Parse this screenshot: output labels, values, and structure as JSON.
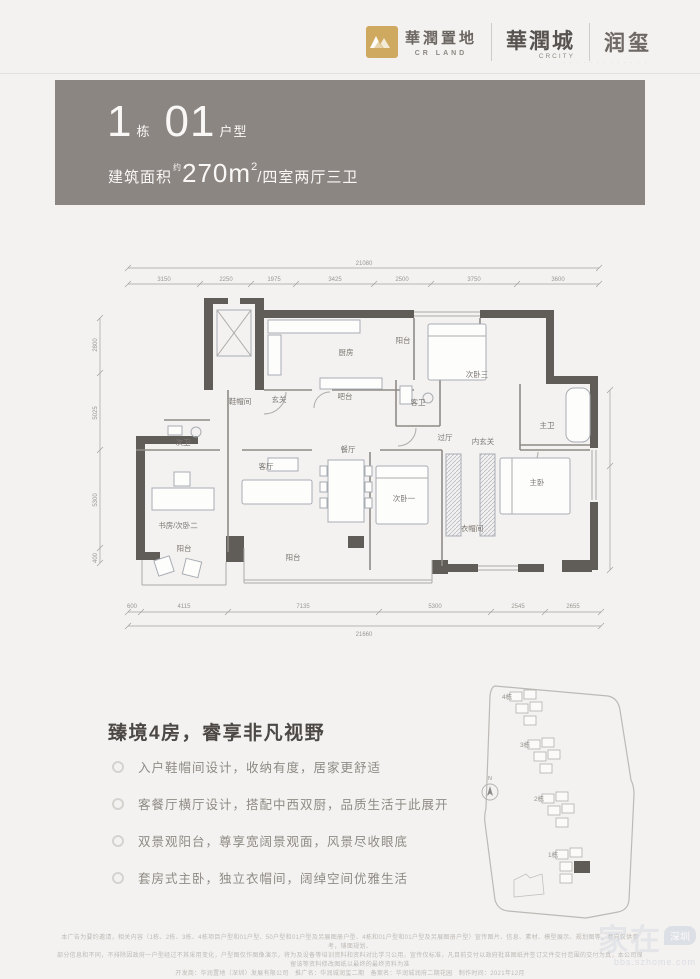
{
  "brand": {
    "crland_cn": "華潤置地",
    "crland_en": "CR LAND",
    "crcity_cn": "華潤城",
    "crcity_en": "CRCITY",
    "runxi": "润玺",
    "tagline": "∙ ∙ ∙   ∙ ∙ ∙ ∙ ∙ ∙ ∙   ∙ ∙ ∙",
    "gold": "#cfa95f"
  },
  "header": {
    "building_num": "1",
    "building_label": "栋",
    "unit_num": "01",
    "unit_label": "户型",
    "area_prefix": "建筑面积",
    "area_sup": "约",
    "area_value": "270m",
    "area_sq": "2",
    "area_suffix": "/四室两厅三卫",
    "band_color": "#8b8682"
  },
  "floorplan": {
    "rooms": {
      "balcony_top": "阳台",
      "kitchen": "厨房",
      "bedroom3": "次卧三",
      "master_bath": "主卫",
      "master_bedroom": "主卧",
      "cloakroom": "衣帽间",
      "bedroom1": "次卧一",
      "inner_foyer": "内玄关",
      "hall": "过厅",
      "guest_bath": "客卫",
      "bar": "吧台",
      "foyer": "玄关",
      "shoe_room": "鞋帽间",
      "second_bath": "次卫",
      "study": "书房/次卧二",
      "living": "客厅",
      "dining": "餐厅",
      "balcony_bottom": "阳台",
      "balcony_left": "阳台"
    },
    "dims_top": {
      "total": "21080",
      "segs": [
        "3150",
        "2250",
        "1975",
        "3425",
        "2500",
        "3750",
        "3600"
      ]
    },
    "dims_bottom": {
      "total": "21660",
      "segs": [
        "600",
        "4115",
        "7135",
        "5300",
        "2545",
        "2655"
      ]
    },
    "dims_left": [
      "2800",
      "5025",
      "5300",
      "400"
    ],
    "wall_color": "#605c58"
  },
  "content": {
    "headline": "臻境4房，睿享非凡视野",
    "bullets": [
      "入户鞋帽间设计，收纳有度，居家更舒适",
      "客餐厅横厅设计，搭配中西双厨，品质生活于此展开",
      "双景观阳台，尊享宽阔景观面，风景尽收眼底",
      "套房式主卧，独立衣帽间，阔绰空间优雅生活"
    ]
  },
  "siteplan": {
    "building4": "4栋",
    "building3": "3栋",
    "building2": "2栋",
    "building1": "1栋",
    "compass": "N"
  },
  "footer": {
    "line1": "本广告为要约邀请，相关内容（1栋、2栋、3栋、4栋项目户型和01户型、50户型和01户型及另展图册户型、4栋和01户型和01户型及另展图册户型）宣传图片、信息、素材、模型展示、规划图等，意向仅供参考，铺面规划、",
    "line2": "部分信息和不同，不排除因政府一户型经过不其采用变化，户型图仅作图像演示，将为及设备等培训资料和资料对比学习公用，宣传仅标准，凡目前交付以政府批准图纸并签订文件交付范围的交付为真，本公司保留该等资料修改图纸以最终的最终资料为准",
    "line3": "开发商：华润置地（深圳）发展有限公司　推广名：华润城润玺二期　备案名：华润城润府二期花园　制作时间：2021年12月"
  },
  "watermark": {
    "main": "家在",
    "badge": "深圳",
    "sub": "bbs.szhome.com"
  }
}
